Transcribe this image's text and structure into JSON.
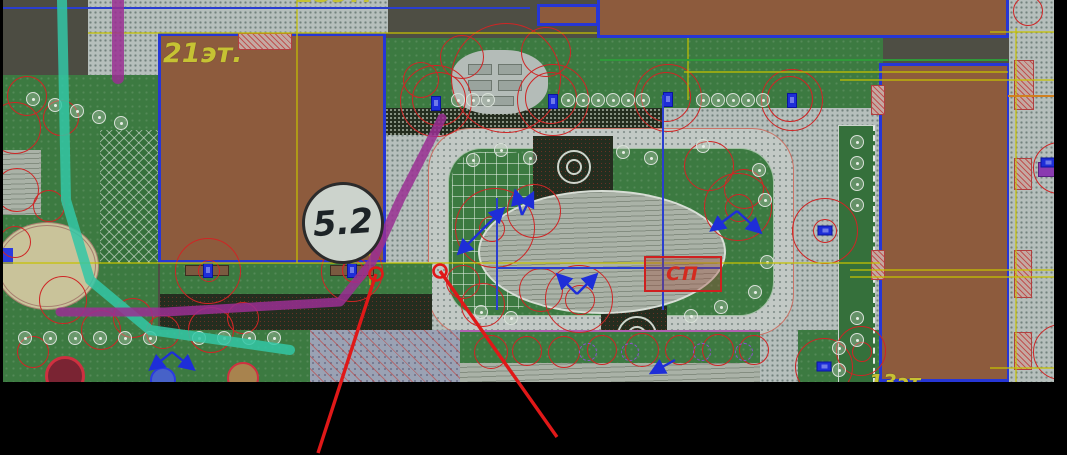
{
  "labels": {
    "left_building_floors": "21эт.",
    "top_building_floors_partial": "15эт.",
    "bottom_right_floors_partial": "13эт.",
    "area_marker": "5.2",
    "sp_box": "СП"
  },
  "palette": {
    "canvas_background": "#000000",
    "drawing_background": "#4e4e44",
    "building_fill": "#8d5b3d",
    "building_outline": "#2636d6",
    "sidewalk": "#b6bfbc",
    "lawn": "#3c7a41",
    "tree_ring": "#cf2525",
    "lamp_blue": "#1e2ed8",
    "grid_yellow": "#c6c200",
    "grid_orange": "#d08020",
    "utility_blue": "#2a3ed0",
    "path_purple": "#9a2f93",
    "path_teal": "#32c7a6",
    "leader_red": "#e01818",
    "label_yellow": "#c6c233"
  },
  "geometry": {
    "trees": [
      [
        433,
        101,
        36
      ],
      [
        436,
        99,
        27
      ],
      [
        550,
        100,
        36
      ],
      [
        548,
        98,
        26
      ],
      [
        665,
        98,
        34
      ],
      [
        663,
        97,
        25
      ],
      [
        789,
        100,
        31
      ],
      [
        787,
        99,
        23
      ],
      [
        503,
        78,
        55
      ],
      [
        459,
        57,
        22
      ],
      [
        543,
        52,
        25
      ],
      [
        418,
        80,
        18
      ],
      [
        492,
        228,
        40
      ],
      [
        531,
        211,
        27
      ],
      [
        489,
        229,
        13
      ],
      [
        735,
        207,
        34
      ],
      [
        736,
        208,
        14
      ],
      [
        706,
        166,
        25
      ],
      [
        741,
        189,
        20
      ],
      [
        576,
        299,
        34
      ],
      [
        577,
        300,
        15
      ],
      [
        538,
        290,
        22
      ],
      [
        480,
        305,
        22
      ],
      [
        460,
        282,
        17
      ],
      [
        205,
        271,
        33
      ],
      [
        206,
        271,
        11
      ],
      [
        349,
        271,
        31
      ],
      [
        350,
        271,
        11
      ],
      [
        352,
        270,
        13
      ],
      [
        822,
        231,
        33
      ],
      [
        822,
        231,
        12
      ],
      [
        821,
        367,
        29
      ],
      [
        858,
        351,
        25
      ],
      [
        859,
        352,
        10
      ],
      [
        24,
        96,
        20
      ],
      [
        58,
        118,
        18
      ],
      [
        14,
        190,
        22
      ],
      [
        46,
        206,
        16
      ],
      [
        12,
        242,
        16
      ],
      [
        60,
        300,
        24
      ],
      [
        98,
        330,
        20
      ],
      [
        30,
        352,
        16
      ],
      [
        130,
        318,
        20
      ],
      [
        160,
        332,
        17
      ],
      [
        208,
        330,
        23
      ],
      [
        240,
        318,
        16
      ],
      [
        12,
        128,
        26
      ],
      [
        488,
        352,
        17
      ],
      [
        524,
        351,
        15
      ],
      [
        561,
        352,
        16
      ],
      [
        599,
        350,
        15
      ],
      [
        639,
        350,
        17
      ],
      [
        677,
        350,
        15
      ],
      [
        715,
        350,
        16
      ],
      [
        751,
        350,
        15
      ],
      [
        1056,
        168,
        26
      ],
      [
        1058,
        352,
        28
      ],
      [
        1025,
        11,
        15
      ]
    ],
    "hedges": [
      [
        455,
        100
      ],
      [
        470,
        100
      ],
      [
        485,
        100
      ],
      [
        565,
        100
      ],
      [
        580,
        100
      ],
      [
        595,
        100
      ],
      [
        610,
        100
      ],
      [
        625,
        100
      ],
      [
        640,
        100
      ],
      [
        700,
        100
      ],
      [
        715,
        100
      ],
      [
        730,
        100
      ],
      [
        745,
        100
      ],
      [
        760,
        100
      ],
      [
        30,
        99
      ],
      [
        52,
        105
      ],
      [
        74,
        111
      ],
      [
        96,
        117
      ],
      [
        118,
        123
      ],
      [
        854,
        142
      ],
      [
        854,
        163
      ],
      [
        854,
        184
      ],
      [
        854,
        205
      ],
      [
        854,
        318
      ],
      [
        854,
        340
      ],
      [
        22,
        338
      ],
      [
        47,
        338
      ],
      [
        72,
        338
      ],
      [
        97,
        338
      ],
      [
        122,
        338
      ],
      [
        147,
        338
      ],
      [
        196,
        338
      ],
      [
        221,
        338
      ],
      [
        246,
        338
      ],
      [
        271,
        338
      ],
      [
        470,
        160
      ],
      [
        498,
        150
      ],
      [
        527,
        158
      ],
      [
        620,
        152
      ],
      [
        648,
        158
      ],
      [
        700,
        146
      ],
      [
        756,
        170
      ],
      [
        762,
        200
      ],
      [
        764,
        262
      ],
      [
        752,
        292
      ],
      [
        718,
        307
      ],
      [
        688,
        316
      ],
      [
        508,
        318
      ],
      [
        478,
        312
      ],
      [
        836,
        348
      ],
      [
        836,
        370
      ]
    ],
    "purple_hedges": [
      [
        585,
        352
      ],
      [
        627,
        352
      ],
      [
        699,
        352
      ],
      [
        741,
        352
      ]
    ],
    "lamps": {
      "vertical": [
        [
          433,
          104
        ],
        [
          550,
          102
        ],
        [
          665,
          100
        ],
        [
          789,
          101
        ],
        [
          205,
          271
        ],
        [
          349,
          271
        ]
      ],
      "horizontal": [
        [
          822,
          231
        ],
        [
          821,
          367
        ],
        [
          1045,
          163
        ]
      ]
    },
    "arrow_lamps": [
      {
        "x": 482,
        "y": 230,
        "vecs": [
          [
            20,
            -20
          ],
          [
            -22,
            22
          ]
        ]
      },
      {
        "x": 522,
        "y": 215,
        "vecs": [
          [
            -6,
            -22
          ],
          [
            10,
            -20
          ]
        ]
      },
      {
        "x": 737,
        "y": 211,
        "vecs": [
          [
            -24,
            18
          ],
          [
            22,
            20
          ]
        ]
      },
      {
        "x": 577,
        "y": 294,
        "vecs": [
          [
            -18,
            -18
          ],
          [
            18,
            -18
          ]
        ]
      },
      {
        "x": 172,
        "y": 352,
        "vecs": [
          [
            -20,
            16
          ],
          [
            20,
            16
          ]
        ]
      },
      {
        "x": 675,
        "y": 360,
        "vecs": [
          [
            -22,
            12
          ]
        ]
      }
    ],
    "lines": {
      "yellow": [
        [
          297,
          0,
          297,
          263
        ],
        [
          3,
          263,
          880,
          263
        ],
        [
          88,
          33,
          597,
          33
        ],
        [
          684,
          72,
          1008,
          72
        ],
        [
          688,
          38,
          688,
          100
        ],
        [
          370,
          228,
          370,
          285
        ],
        [
          850,
          270,
          1054,
          270
        ],
        [
          850,
          277,
          1054,
          277
        ],
        [
          840,
          80,
          1054,
          80
        ],
        [
          990,
          32,
          1054,
          32
        ],
        [
          990,
          368,
          1054,
          368
        ],
        [
          1016,
          28,
          1016,
          382
        ]
      ],
      "orange": [
        [
          1008,
          96,
          1054,
          96
        ]
      ],
      "blue": [
        [
          663,
          95,
          663,
          310
        ],
        [
          497,
          198,
          497,
          310
        ],
        [
          497,
          268,
          720,
          268
        ],
        [
          3,
          8,
          530,
          8
        ]
      ],
      "green": [
        [
          600,
          60,
          1008,
          60
        ]
      ]
    },
    "paths": {
      "teal": {
        "points": [
          [
            62,
            0
          ],
          [
            66,
            200
          ],
          [
            90,
            280
          ],
          [
            150,
            330
          ],
          [
            290,
            350
          ]
        ],
        "width": 10
      },
      "purple": {
        "points": [
          [
            442,
            118
          ],
          [
            400,
            200
          ],
          [
            372,
            262
          ],
          [
            340,
            302
          ],
          [
            165,
            312
          ],
          [
            60,
            312
          ]
        ],
        "width": 9
      },
      "purple2": {
        "points": [
          [
            118,
            0
          ],
          [
            118,
            78
          ]
        ],
        "width": 12
      }
    },
    "leaders": [
      {
        "tip": [
          376,
          274
        ],
        "end": [
          318,
          453
        ]
      },
      {
        "tip": [
          440,
          271
        ],
        "end": [
          557,
          437
        ]
      }
    ]
  }
}
